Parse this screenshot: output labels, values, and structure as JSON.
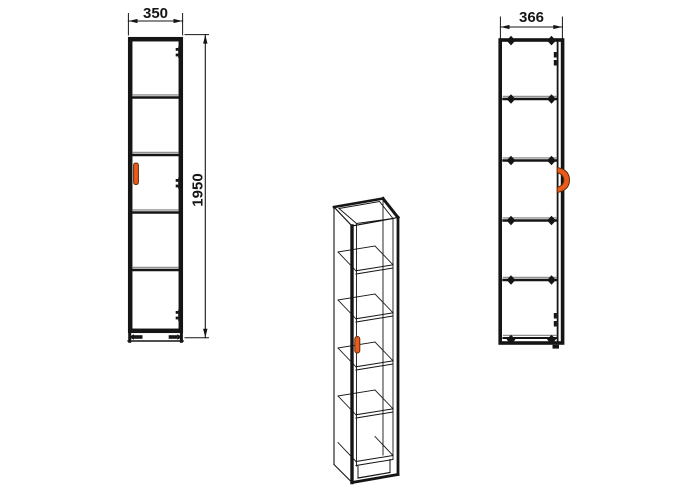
{
  "diagram": {
    "views": {
      "front": {
        "width_label": "350",
        "height_label": "1950",
        "shelf_lines": 4,
        "sections": 5,
        "hinge_markers": 3,
        "foot_markers": 2,
        "handle_icon": "door-handle-bar"
      },
      "perspective": {
        "shelf_count": 4,
        "handle_icon": "door-handle-bar"
      },
      "side": {
        "depth_label": "366",
        "fastener_rows": 6,
        "fasteners_per_row": 2,
        "handle_icon": "door-handle-c-profile"
      }
    }
  },
  "colors": {
    "background": "#ffffff",
    "line": "#151515",
    "shadow-line": "#909090",
    "accent-handle": "#ea5b1b",
    "handle-outline": "#5f2a08"
  }
}
